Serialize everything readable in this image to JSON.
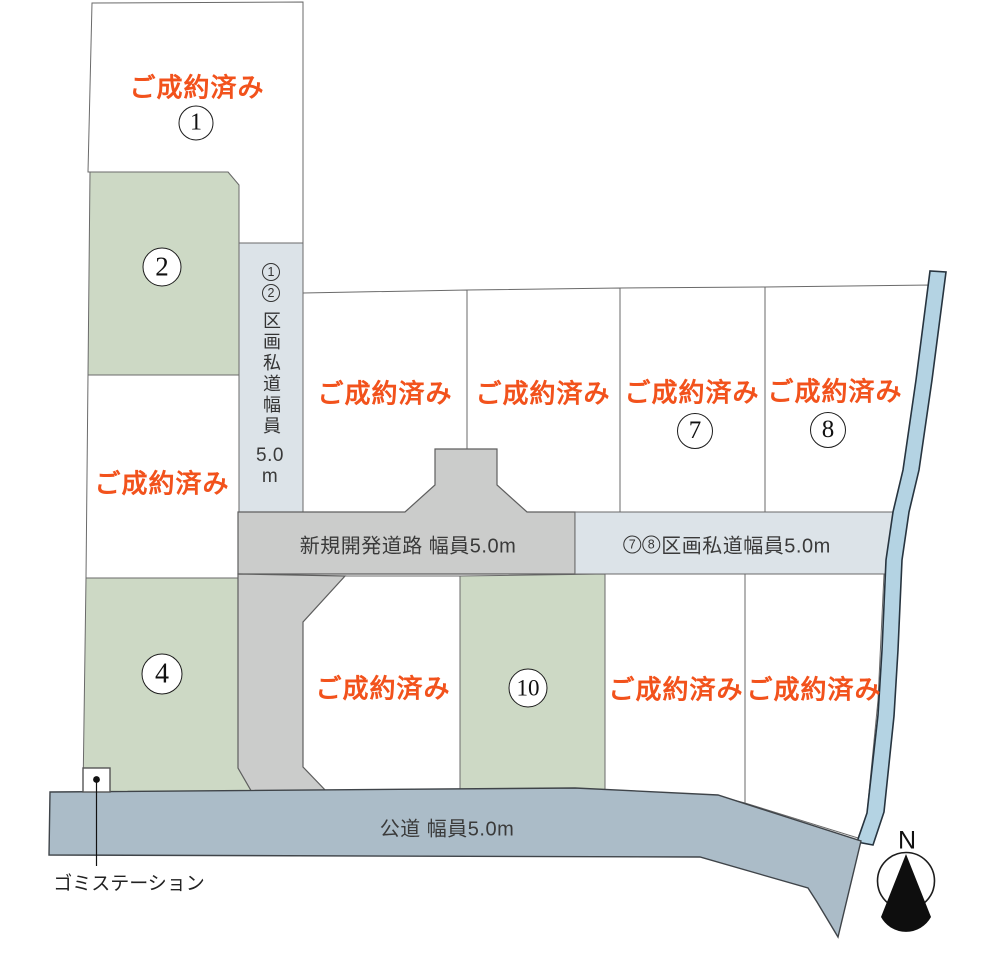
{
  "map_title": "区画図",
  "plots": {
    "p1": {
      "sold": "ご成約済み",
      "num": "1"
    },
    "p2": {
      "num": "2"
    },
    "p3": {
      "sold": "ご成約済み"
    },
    "p4": {
      "num": "4"
    },
    "pm1": {
      "sold": "ご成約済み"
    },
    "pm2": {
      "sold": "ご成約済み"
    },
    "p7": {
      "sold": "ご成約済み",
      "num": "7"
    },
    "p8": {
      "sold": "ご成約済み",
      "num": "8"
    },
    "pb1": {
      "sold": "ご成約済み"
    },
    "p10": {
      "num": "10"
    },
    "pb3": {
      "sold": "ご成約済み"
    },
    "pb4": {
      "sold": "ご成約済み"
    }
  },
  "roads": {
    "private_12": {
      "num1": "1",
      "num2": "2",
      "label": "区画私道幅員",
      "width_value": "5.0",
      "width_unit": "m"
    },
    "new_dev": {
      "label": "新規開発道路 幅員5.0m"
    },
    "private_78": {
      "num1": "7",
      "num2": "8",
      "label": "区画私道幅員5.0m"
    },
    "public": {
      "label": "公道 幅員5.0m"
    }
  },
  "annotations": {
    "garbage_station": "ゴミステーション",
    "compass_n": "N"
  },
  "colors": {
    "plot_white": "#ffffff",
    "plot_green": "#cdd9c5",
    "road_private": "#dce3e8",
    "road_new": "#cbcccb",
    "road_public": "#abbcc8",
    "river": "#b4d3e3",
    "river_stroke": "#27343f",
    "sold_text": "#f2521c",
    "outline": "#6a6a6a",
    "text": "#3a3a3a"
  }
}
